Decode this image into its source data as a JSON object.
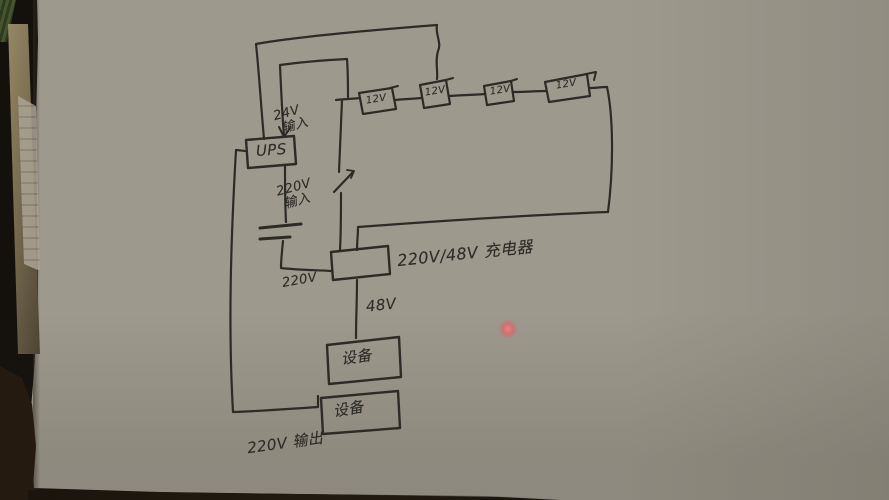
{
  "photo": {
    "description": "Photo of a hand-drawn UPS / battery / charger wiring sketch on paper",
    "ink_color": "#2c2b26",
    "paper_color": "#a8a499",
    "laser_dot_color": "#de6469"
  },
  "labels": {
    "ups": "UPS",
    "input_24v_line1": "24V",
    "input_24v_line2": "输入",
    "input_220v_line1": "220V",
    "input_220v_line2": "输入",
    "mains_220v": "220V",
    "converter": "220V/48V 充电器",
    "output_48v": "48V",
    "device_top": "设备",
    "device_bottom": "设备",
    "output_220v": "220V 输出"
  },
  "batteries": [
    "12V",
    "12V",
    "12V",
    "12V"
  ]
}
